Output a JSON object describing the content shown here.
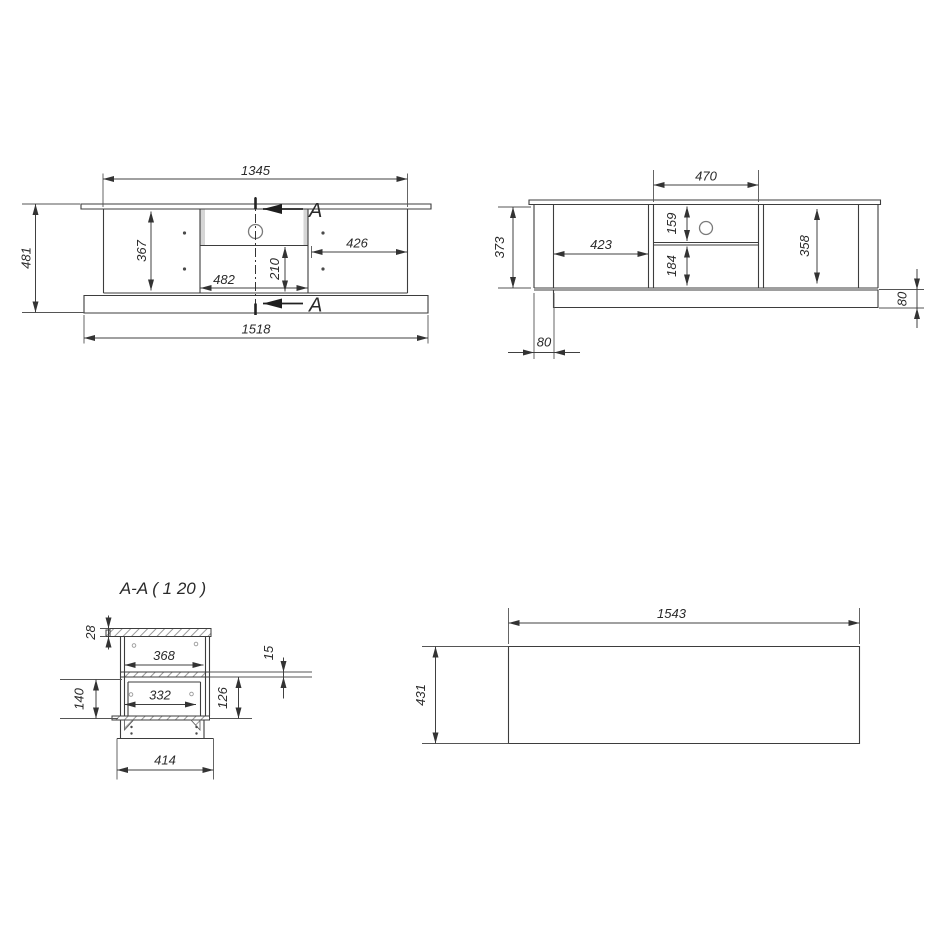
{
  "drawing": {
    "section_title": "A-A ( 1  20 )",
    "section_letter": "A",
    "front_view": {
      "body_width": "1345",
      "overall_height": "481",
      "door_height": "367",
      "drawer_width": "482",
      "drawer_height": "210",
      "right_door_width": "426",
      "base_width": "1518"
    },
    "rear_view": {
      "niche_width": "470",
      "niche_upper_height": "159",
      "niche_lower_height": "184",
      "left_niche_width": "423",
      "right_niche_height": "358",
      "body_height": "373",
      "plinth_inset": "80",
      "plinth_height": "80"
    },
    "section_view": {
      "top_panel_thickness": "28",
      "upper_inner_depth": "368",
      "shelf_thickness": "15",
      "drawer_opening_height": "140",
      "drawer_inner_depth": "332",
      "lower_opening_height": "126",
      "plinth_depth": "414"
    },
    "top_view": {
      "top_panel_width": "1543",
      "top_panel_depth": "431"
    }
  }
}
